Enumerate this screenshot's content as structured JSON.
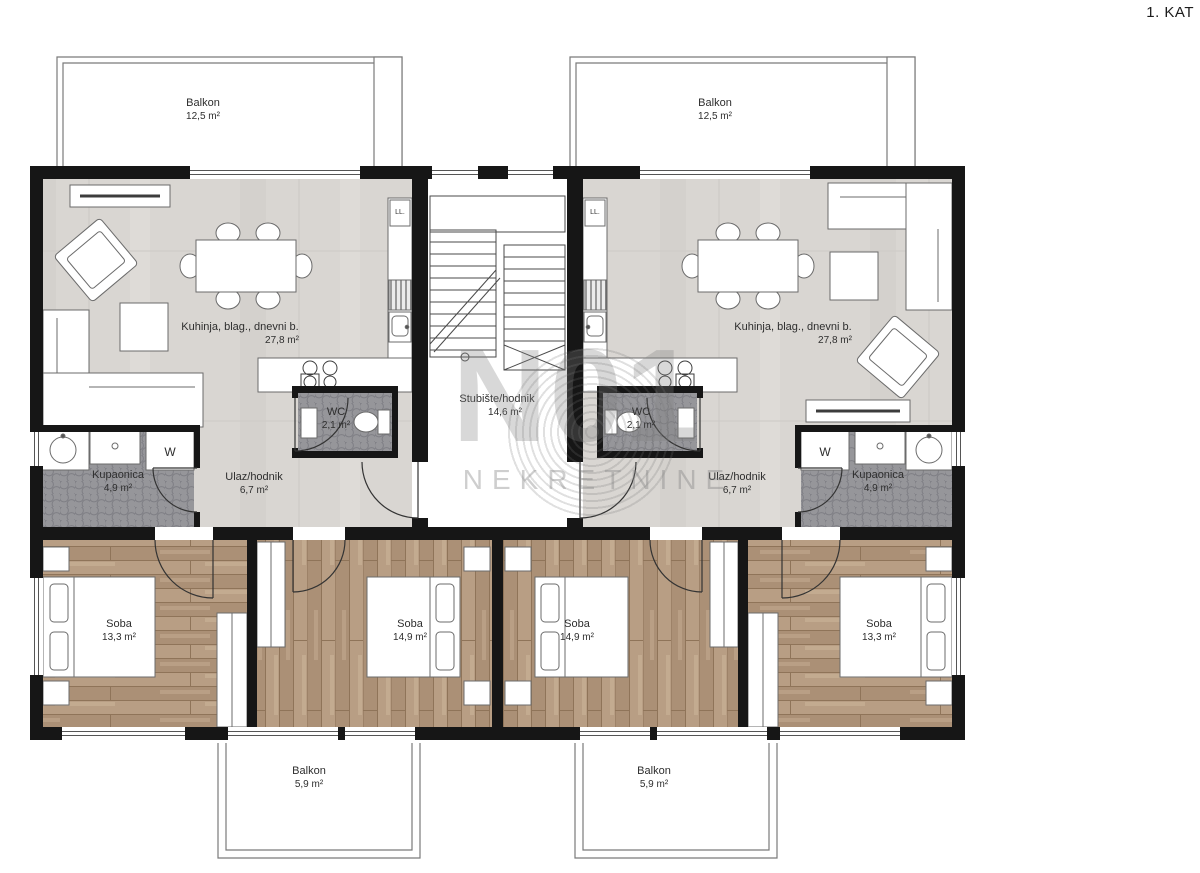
{
  "page": {
    "title": "1. KAT"
  },
  "watermark": {
    "line1": "N01",
    "line2": "NEKRETNINE"
  },
  "appliances": {
    "washer": "W",
    "fridge": "LL."
  },
  "colors": {
    "wall": "#161616",
    "floor_light": "#d9d6d2",
    "floor_tile_dark": "#96969a",
    "floor_wood": "#b49a7f",
    "furniture_line": "#6b6b6b",
    "watermark": "#b9b9b9"
  },
  "rooms": [
    {
      "id": "balkon-top-left",
      "label": "Balkon",
      "area": "12,5 m²"
    },
    {
      "id": "balkon-top-right",
      "label": "Balkon",
      "area": "12,5 m²"
    },
    {
      "id": "living-left",
      "label": "Kuhinja, blag., dnevni b.",
      "area": "27,8 m²"
    },
    {
      "id": "living-right",
      "label": "Kuhinja, blag., dnevni b.",
      "area": "27,8 m²"
    },
    {
      "id": "wc-left",
      "label": "WC",
      "area": "2,1 m²"
    },
    {
      "id": "wc-right",
      "label": "WC",
      "area": "2,1 m²"
    },
    {
      "id": "staircase",
      "label": "Stubište/hodnik",
      "area": "14,6 m²"
    },
    {
      "id": "hall-left",
      "label": "Ulaz/hodnik",
      "area": "6,7 m²"
    },
    {
      "id": "bath-left",
      "label": "Kupaonica",
      "area": "4,9 m²"
    },
    {
      "id": "hall-right",
      "label": "Ulaz/hodnik",
      "area": "6,7 m²"
    },
    {
      "id": "bath-right",
      "label": "Kupaonica",
      "area": "4,9 m²"
    },
    {
      "id": "bedroom-1",
      "label": "Soba",
      "area": "13,3 m²"
    },
    {
      "id": "bedroom-2",
      "label": "Soba",
      "area": "14,9 m²"
    },
    {
      "id": "bedroom-3",
      "label": "Soba",
      "area": "14,9 m²"
    },
    {
      "id": "bedroom-4",
      "label": "Soba",
      "area": "13,3 m²"
    }
  ],
  "balconies_bottom": [
    {
      "id": "balkon-bottom-left",
      "label": "Balkon",
      "area": "5,9 m²"
    },
    {
      "id": "balkon-bottom-right",
      "label": "Balkon",
      "area": "5,9 m²"
    }
  ]
}
